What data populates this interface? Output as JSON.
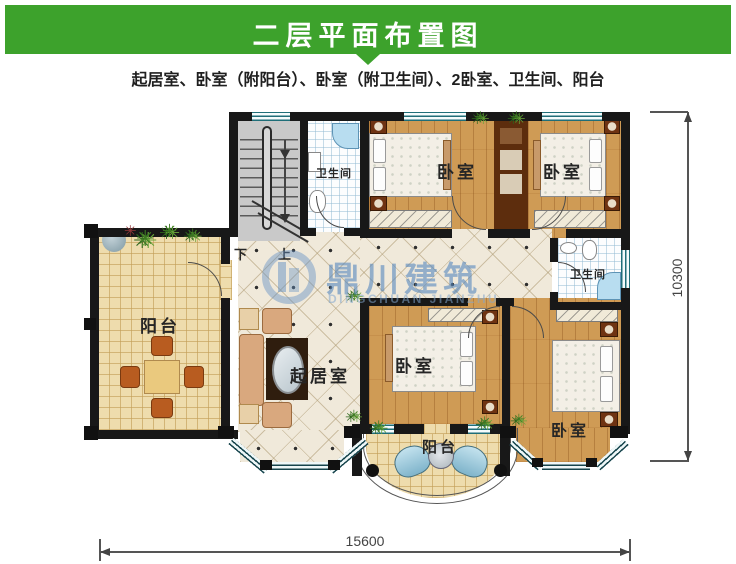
{
  "header": {
    "title": "二层平面布置图"
  },
  "subtitle": "起居室、卧室（附阳台）、卧室（附卫生间）、2卧室、卫生间、阳台",
  "watermark": {
    "cn": "鼎川建筑",
    "en": "DINGCHUAN JIANZHU"
  },
  "rooms": {
    "balcony_left": "阳台",
    "balcony_bottom": "阳台",
    "living": "起居室",
    "bath_top": "卫生间",
    "bath_mid": "卫生间",
    "bedroom_top_mid": "卧室",
    "bedroom_top_right": "卧室",
    "bedroom_bottom_mid": "卧室",
    "bedroom_bottom_right": "卧室"
  },
  "stairs": {
    "down": "下",
    "up": "上"
  },
  "dimensions": {
    "width_mm": "15600",
    "height_mm": "10300"
  },
  "icons": {
    "plant": "✳"
  },
  "colors": {
    "header_green": "#3da22c",
    "wall_black": "#181818",
    "wood_floor": "#cf9b55",
    "hall_tile": "#f0e9da",
    "balcony_tile": "#eedcad",
    "watermark_blue": "#5587be"
  }
}
